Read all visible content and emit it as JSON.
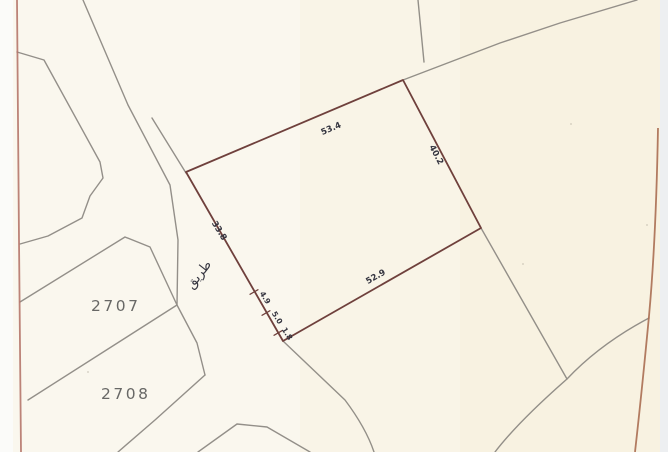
{
  "map": {
    "type": "cadastral-survey-plan",
    "road_label": "طريق",
    "parcels": {
      "p2707": "2707",
      "p2708": "2708"
    },
    "subject_parcel": {
      "dim_top": "53.4",
      "dim_right": "40.2",
      "dim_bottom": "52.9",
      "dim_left": "33.8",
      "seg_a": "4.9",
      "seg_b": "5.0",
      "seg_c": "1.8"
    },
    "colors": {
      "paper": "#faf7ee",
      "paper_warm": "#f6efda",
      "page_edge_left": "#fbfbf9",
      "page_edge_right": "#edeff1",
      "parcel_line": "#8b8781",
      "subject_boundary": "#6f403c",
      "sheet_border_left": "#b5766a",
      "sheet_border_right": "#aa6e52",
      "dim_text": "#34343f",
      "parcel_text": "#686866"
    }
  }
}
